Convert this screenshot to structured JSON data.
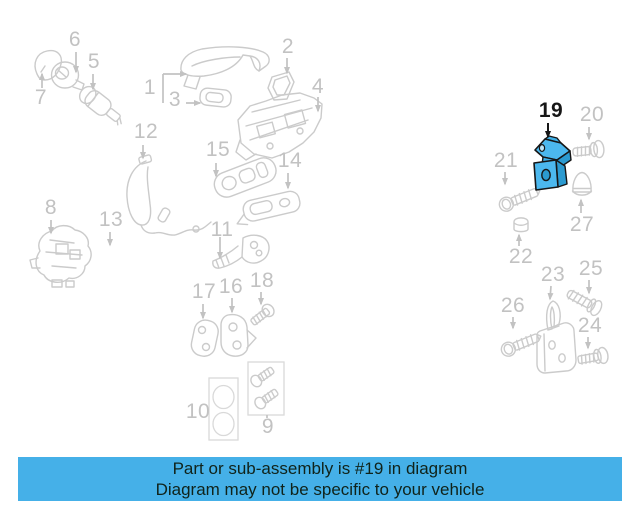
{
  "page": {
    "width": 640,
    "height": 512,
    "background": "#ffffff"
  },
  "banner": {
    "line1": "Part or sub-assembly is #19 in diagram",
    "line2": "Diagram may not be specific to your vehicle",
    "bg_color": "#45b0e8",
    "text_color": "#10231a"
  },
  "diagram": {
    "highlighted_part_number": "19",
    "line_color": "#cbcbcb",
    "label_color": "#c2c2c2",
    "highlight_fill": "#4cb8ee",
    "highlight_shade": "#2b9ad0",
    "highlight_outline": "#161616",
    "labels": [
      {
        "num": "6",
        "x": 75,
        "y": 40
      },
      {
        "num": "5",
        "x": 94,
        "y": 62
      },
      {
        "num": "7",
        "x": 41,
        "y": 98
      },
      {
        "num": "2",
        "x": 288,
        "y": 47
      },
      {
        "num": "1",
        "x": 150,
        "y": 88
      },
      {
        "num": "3",
        "x": 175,
        "y": 100
      },
      {
        "num": "4",
        "x": 318,
        "y": 87
      },
      {
        "num": "12",
        "x": 146,
        "y": 132
      },
      {
        "num": "15",
        "x": 218,
        "y": 150
      },
      {
        "num": "14",
        "x": 290,
        "y": 161
      },
      {
        "num": "8",
        "x": 51,
        "y": 208
      },
      {
        "num": "13",
        "x": 111,
        "y": 220
      },
      {
        "num": "11",
        "x": 222,
        "y": 230
      },
      {
        "num": "17",
        "x": 204,
        "y": 292
      },
      {
        "num": "16",
        "x": 231,
        "y": 287
      },
      {
        "num": "18",
        "x": 262,
        "y": 281
      },
      {
        "num": "10",
        "x": 198,
        "y": 412
      },
      {
        "num": "9",
        "x": 268,
        "y": 427
      },
      {
        "num": "19",
        "x": 551,
        "y": 111,
        "highlight": true
      },
      {
        "num": "20",
        "x": 592,
        "y": 115
      },
      {
        "num": "21",
        "x": 506,
        "y": 161
      },
      {
        "num": "27",
        "x": 582,
        "y": 225
      },
      {
        "num": "22",
        "x": 521,
        "y": 257
      },
      {
        "num": "23",
        "x": 553,
        "y": 275
      },
      {
        "num": "25",
        "x": 591,
        "y": 269
      },
      {
        "num": "26",
        "x": 513,
        "y": 306
      },
      {
        "num": "24",
        "x": 590,
        "y": 326
      }
    ],
    "arrows": [
      {
        "x1": 76,
        "y1": 52,
        "x2": 76,
        "y2": 72
      },
      {
        "x1": 93,
        "y1": 74,
        "x2": 93,
        "y2": 89
      },
      {
        "x1": 42,
        "y1": 88,
        "x2": 42,
        "y2": 74
      },
      {
        "x1": 287,
        "y1": 58,
        "x2": 287,
        "y2": 73
      },
      {
        "x1": 163,
        "y1": 74,
        "x2": 186,
        "y2": 74
      },
      {
        "x1": 186,
        "y1": 103,
        "x2": 200,
        "y2": 103
      },
      {
        "x1": 318,
        "y1": 97,
        "x2": 318,
        "y2": 111
      },
      {
        "x1": 143,
        "y1": 145,
        "x2": 143,
        "y2": 158
      },
      {
        "x1": 216,
        "y1": 163,
        "x2": 216,
        "y2": 176
      },
      {
        "x1": 288,
        "y1": 173,
        "x2": 288,
        "y2": 188
      },
      {
        "x1": 51,
        "y1": 220,
        "x2": 51,
        "y2": 233
      },
      {
        "x1": 110,
        "y1": 232,
        "x2": 110,
        "y2": 245
      },
      {
        "x1": 220,
        "y1": 237,
        "x2": 220,
        "y2": 258
      },
      {
        "x1": 203,
        "y1": 304,
        "x2": 203,
        "y2": 318
      },
      {
        "x1": 232,
        "y1": 298,
        "x2": 232,
        "y2": 312
      },
      {
        "x1": 261,
        "y1": 292,
        "x2": 261,
        "y2": 304
      },
      {
        "x1": 548,
        "y1": 123,
        "x2": 548,
        "y2": 137,
        "black": true
      },
      {
        "x1": 589,
        "y1": 127,
        "x2": 589,
        "y2": 139
      },
      {
        "x1": 505,
        "y1": 172,
        "x2": 505,
        "y2": 184
      },
      {
        "x1": 581,
        "y1": 213,
        "x2": 581,
        "y2": 200
      },
      {
        "x1": 519,
        "y1": 246,
        "x2": 519,
        "y2": 235
      },
      {
        "x1": 551,
        "y1": 286,
        "x2": 550,
        "y2": 299
      },
      {
        "x1": 589,
        "y1": 280,
        "x2": 589,
        "y2": 293
      },
      {
        "x1": 513,
        "y1": 317,
        "x2": 513,
        "y2": 328
      },
      {
        "x1": 588,
        "y1": 337,
        "x2": 588,
        "y2": 348
      }
    ],
    "lines": [
      {
        "x1": 163,
        "y1": 74,
        "x2": 163,
        "y2": 103
      },
      {
        "x1": 267,
        "y1": 415,
        "x2": 267,
        "y2": 418
      }
    ]
  }
}
